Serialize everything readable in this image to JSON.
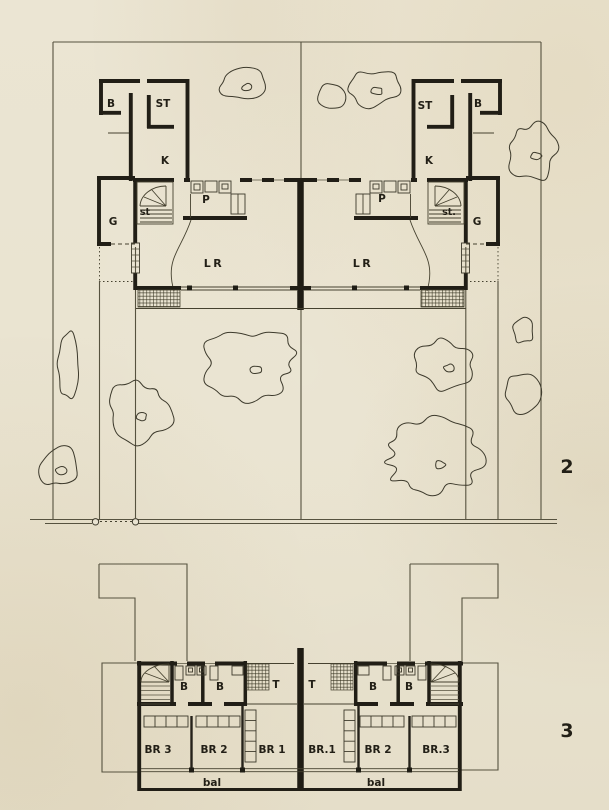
{
  "colors": {
    "paper": "#e9e3d1",
    "ink": "#211e16",
    "thin_line": "#45412f"
  },
  "plan2": {
    "figure_number": "2",
    "left": {
      "bath": "B",
      "storage": "ST",
      "kitchen": "K",
      "stairs": "st",
      "garage": "G",
      "pantry": "P",
      "living_room": "LR"
    },
    "right": {
      "storage": "ST",
      "bath": "B",
      "kitchen": "K",
      "pantry": "P",
      "stairs": "st.",
      "garage": "G",
      "living_room": "LR"
    }
  },
  "plan3": {
    "figure_number": "3",
    "left": {
      "bath1": "B",
      "bath2": "B",
      "terrace": "T",
      "bedroom3": "BR 3",
      "bedroom2": "BR 2",
      "bedroom1": "BR 1",
      "balcony": "bal"
    },
    "right": {
      "terrace": "T",
      "bath1": "B",
      "bath2": "B",
      "bedroom1": "BR.1",
      "bedroom2": "BR 2",
      "bedroom3": "BR.3",
      "balcony": "bal"
    }
  }
}
